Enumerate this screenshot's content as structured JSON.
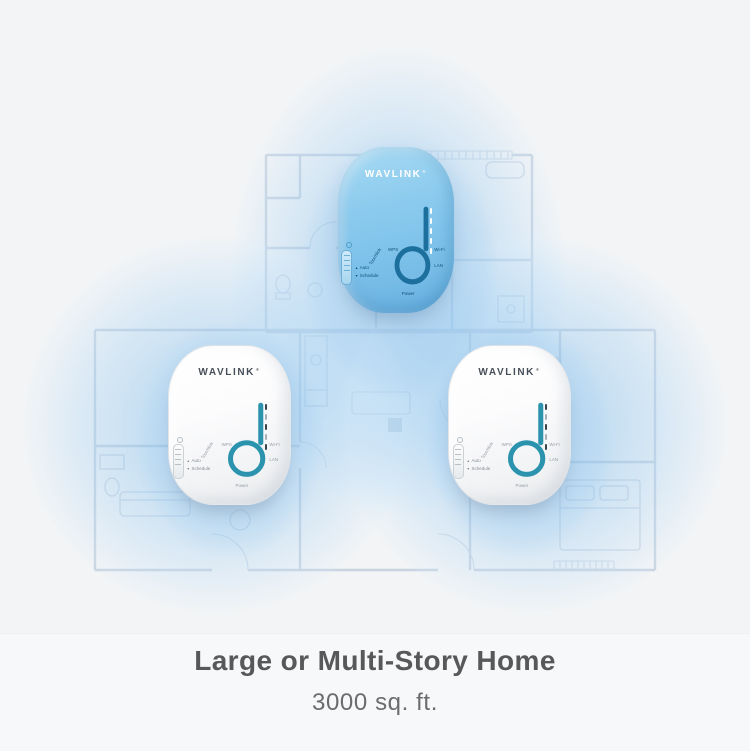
{
  "caption": {
    "title": "Large or Multi-Story Home",
    "subtitle": "3000 sq. ft."
  },
  "brand": {
    "logo": "WAVLINK",
    "reg_mark": "®"
  },
  "devices": [
    {
      "id": "top",
      "variant": "blue",
      "logo": "WAVLINK"
    },
    {
      "id": "left",
      "variant": "white",
      "logo": "WAVLINK"
    },
    {
      "id": "right",
      "variant": "white",
      "logo": "WAVLINK"
    }
  ],
  "device_labels": {
    "auto": "Auto",
    "schedule": "Schedule",
    "wps": "WPS",
    "touchlink": "Touchlink",
    "wifi": "Wi-Fi",
    "lan": "LAN",
    "power": "Power",
    "marker_up": "▲",
    "marker_down": "▼"
  },
  "colors": {
    "background": "#f3f4f5",
    "coverage_blue": "#8cc3ee",
    "floorplan_line": "#c2cedd",
    "device_blue_body": "#7ec2ea",
    "device_white_body": "#f5f6f7",
    "ring_teal": "#2b93ad",
    "ring_blue_device": "#1d6f9e",
    "title_text": "#57585a",
    "subtitle_text": "#6b6c6e"
  }
}
